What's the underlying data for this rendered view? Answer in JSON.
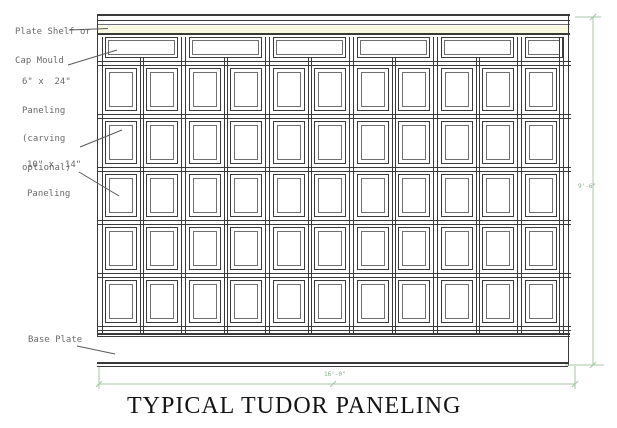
{
  "title": "TYPICAL TUDOR PANELING",
  "labels": {
    "plate_shelf": [
      "Plate Shelf or",
      "Cap Mould"
    ],
    "top_paneling": [
      "6\" x  24\"",
      "Paneling",
      "(carving",
      "optional)"
    ],
    "field_paneling": [
      "10\" x  14\"",
      "Paneling"
    ],
    "base_plate": "Base Plate"
  },
  "dimensions": {
    "height": "9'-6\"",
    "width": "16'-0\""
  },
  "wall": {
    "bays": [
      2,
      2,
      2,
      2,
      2,
      1
    ],
    "panel_rows": 5
  },
  "colors": {
    "line": "#3a3a3a",
    "inner_line": "#6f6f6f",
    "leader": "#5a5a5a",
    "label_text": "#6b6b6b",
    "dimension": "#a4c7a4",
    "dimension_text": "#85ad85",
    "cap_mould_fill": "#fafae0",
    "title_text": "#141414",
    "background": "#ffffff"
  }
}
